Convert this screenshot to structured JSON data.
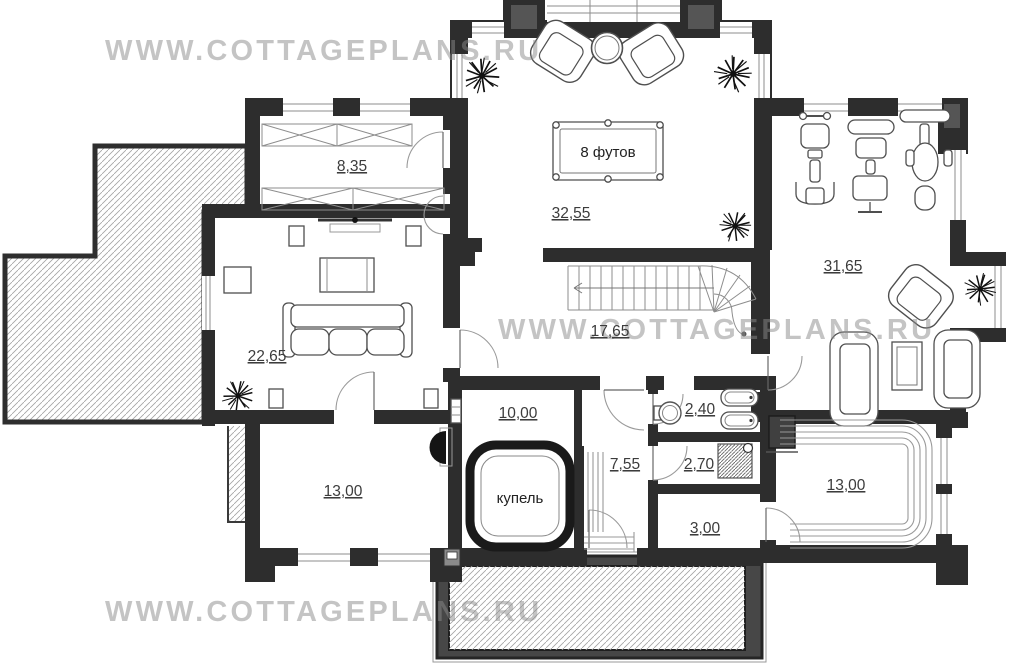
{
  "watermark": {
    "text": "WWW.COTTAGEPLANS.RU",
    "color": "#bdbdbd"
  },
  "labels": {
    "billiard_table": "8 футов",
    "plunge_pool": "купель"
  },
  "rooms": {
    "wardrobe": "8,35",
    "billiard": "32,55",
    "gym": "31,65",
    "living": "22,65",
    "hall": "17,65",
    "pool_room": "10,00",
    "bathroom": "2,40",
    "steam_anteroom": "7,55",
    "shower": "2,70",
    "corridor": "3,00",
    "room_left": "13,00",
    "sauna": "13,00"
  },
  "fixtures": [
    "billiard-table",
    "armchair",
    "round-table",
    "sofa",
    "tv",
    "coffee-table",
    "stairs",
    "gym-equipment",
    "plunge-pool",
    "bathtub",
    "washbasin",
    "shower-tray",
    "sauna-bench",
    "sauna-stove",
    "plant",
    "fireplace",
    "terrace",
    "porch-steps"
  ],
  "colors": {
    "wall": "#2d2d2d",
    "wall_accent": "#555555",
    "hatch_line": "#a3a3a3",
    "area_label": "#3c3c3c",
    "furniture_line": "#4f4f4f",
    "watermark_gray": "#bdbdbd"
  }
}
